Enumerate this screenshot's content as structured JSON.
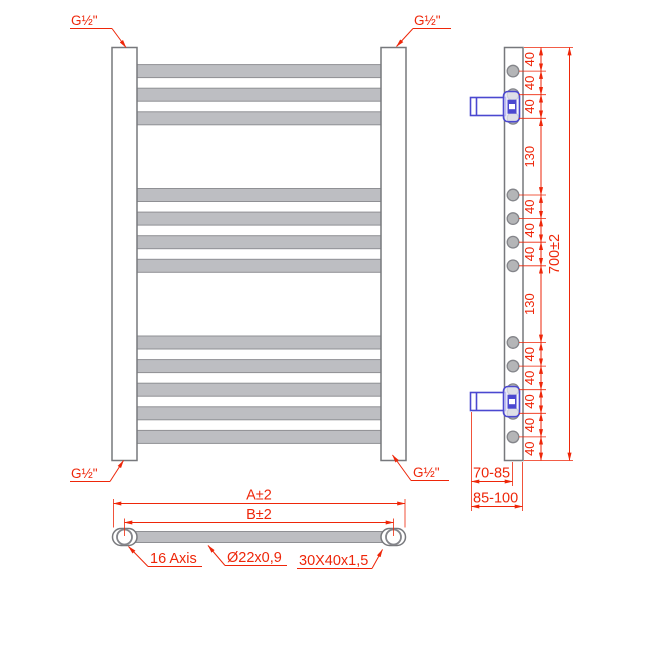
{
  "labels": {
    "connection": "G½\"",
    "dim40": "40",
    "dim130": "130",
    "height_total": "700±2",
    "wall_to_center": "70-85",
    "wall_to_face": "85-100",
    "width_outer": "A±2",
    "width_inner": "B±2",
    "axis": "16 Axis",
    "tube": "Ø22x0,9",
    "profile": "30X40x1,5"
  },
  "colors": {
    "dimension_red": "#ee2609",
    "bracket_blue": "#4b48d0",
    "metal_fill": "#bdbec2",
    "metal_outline": "#77787c"
  }
}
